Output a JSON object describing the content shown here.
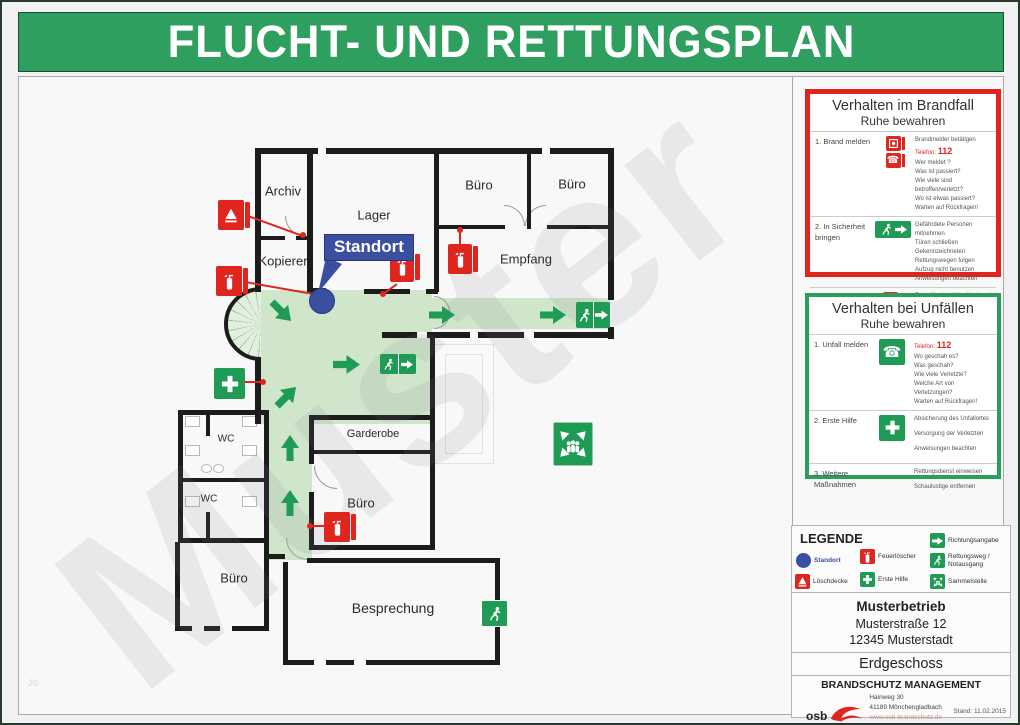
{
  "title": "FLUCHT- UND RETTUNGSPLAN",
  "watermark": "Muster",
  "page_number": "20",
  "colors": {
    "header_green": "#2f9f60",
    "sign_green": "#1f9b55",
    "route_green": "#cfe6cb",
    "alarm_red": "#e0251f",
    "standort_blue": "#3b4fa0"
  },
  "plan": {
    "standort_label": "Standort",
    "rooms": [
      {
        "id": "archiv",
        "label": "Archiv"
      },
      {
        "id": "lager",
        "label": "Lager"
      },
      {
        "id": "kopierer",
        "label": "Kopierer"
      },
      {
        "id": "buero-1",
        "label": "Büro"
      },
      {
        "id": "buero-2",
        "label": "Büro"
      },
      {
        "id": "empfang",
        "label": "Empfang"
      },
      {
        "id": "garderobe",
        "label": "Garderobe"
      },
      {
        "id": "wc-1",
        "label": "WC"
      },
      {
        "id": "wc-2",
        "label": "WC"
      },
      {
        "id": "buero-3",
        "label": "Büro"
      },
      {
        "id": "buero-4",
        "label": "Büro"
      },
      {
        "id": "besprechung",
        "label": "Besprechung"
      }
    ]
  },
  "fire_panel": {
    "title": "Verhalten im Brandfall",
    "subtitle": "Ruhe bewahren",
    "steps": [
      {
        "name": "1. Brand melden",
        "intro": "Brandmelder betätigen",
        "phone_label": "Telefon:",
        "phone": "112",
        "details": [
          "Wer meldet ?",
          "Was ist passiert?",
          "Wie viele sind betroffen/verletzt?",
          "Wo ist etwas passiert?",
          "Warten auf Rückfragen!"
        ]
      },
      {
        "name": "2. In Sicherheit bringen",
        "details": [
          "Gefährdete Personen mitnehmen",
          "Türen schließen",
          "Gekennzeichneten Rettungswegen folgen",
          "Aufzug nicht benutzen",
          "Anweisungen beachten"
        ]
      },
      {
        "name": "3. Löschversuch unternehmen",
        "details": [
          "Feuerlöscher, Wandhydrant / Löschschlauch, Mittel und Geräte zur Brandbekämpfung benutzen"
        ]
      }
    ]
  },
  "accident_panel": {
    "title": "Verhalten bei Unfällen",
    "subtitle": "Ruhe bewahren",
    "steps": [
      {
        "name": "1. Unfall melden",
        "phone_label": "Telefon:",
        "phone": "112",
        "details": [
          "Wo geschah es?",
          "Was geschah?",
          "Wie viele Verletzte?",
          "Welche Art von Verletzungen?",
          "Warten auf Rückfragen!"
        ]
      },
      {
        "name": "2. Erste Hilfe",
        "details": [
          "Absicherung des Unfallortes",
          "Versorgung der Verletzten",
          "Anweisungen beachten"
        ]
      },
      {
        "name": "3. Weitere Maßnahmen",
        "details": [
          "Rettungsdienst einweisen",
          "Schaulustige entfernen"
        ]
      }
    ]
  },
  "legend": {
    "title": "LEGENDE",
    "items": [
      {
        "icon": "standort",
        "label": "Standort"
      },
      {
        "icon": "loeschdecke",
        "label": "Löschdecke"
      },
      {
        "icon": "feuerloescher",
        "label": "Feuerlöscher"
      },
      {
        "icon": "erste-hilfe",
        "label": "Erste Hilfe"
      },
      {
        "icon": "richtungsangabe",
        "label": "Richtungsangabe"
      },
      {
        "icon": "rettungsweg",
        "label": "Rettungsweg / Notausgang"
      },
      {
        "icon": "sammelstelle",
        "label": "Sammelstelle"
      }
    ]
  },
  "info": {
    "company": "Musterbetrieb",
    "street": "Musterstraße 12",
    "city": "12345 Musterstadt",
    "floor": "Erdgeschoss",
    "org": "BRANDSCHUTZ MANAGEMENT",
    "logo": "osb",
    "address1": "Hainweg 30",
    "address2": "41189 Mönchengladbach",
    "web": "www.osb-brandschutz.de",
    "mail": "Mail: info@osb-brandschutz.de",
    "stand": "Stand: 11.02.2015"
  }
}
